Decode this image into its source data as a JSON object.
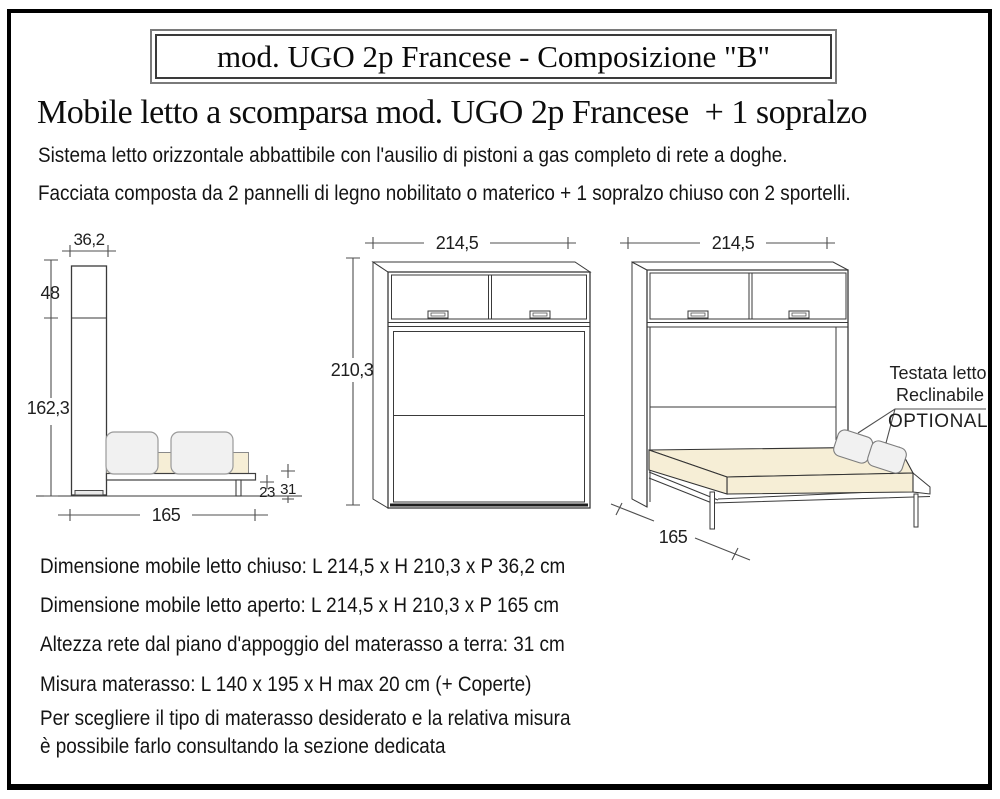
{
  "title_box": {
    "text": "mod. UGO 2p Francese - Composizione \"B\""
  },
  "heading": "Mobile letto a scomparsa mod. UGO 2p Francese  + 1 sopralzo",
  "intro": [
    "Sistema letto orizzontale abbattibile con l'ausilio di pistoni a gas completo di rete a doghe.",
    "Facciata composta da 2 pannelli di legno nobilitato o materico + 1 sopralzo chiuso con 2 sportelli."
  ],
  "diagrams": {
    "side_view": {
      "depth_closed_cm": "36,2",
      "sopralzo_height_cm": "48",
      "body_height_cm": "162,3",
      "depth_open_cm": "165",
      "platform_height_cm": "23",
      "rete_height_cm": "31"
    },
    "front_view": {
      "width_cm": "214,5",
      "height_cm": "210,3"
    },
    "open_view": {
      "width_cm": "214,5",
      "depth_open_cm": "165",
      "headboard_line1": "Testata letto",
      "headboard_line2": "Reclinabile",
      "headboard_line3": "OPTIONAL"
    }
  },
  "specs": [
    "Dimensione mobile letto chiuso: L 214,5 x H 210,3 x P 36,2 cm",
    "Dimensione mobile letto aperto: L 214,5 x H 210,3 x P 165 cm",
    "Altezza rete dal piano d'appoggio del materasso a terra: 31 cm",
    "Misura materasso: L 140 x 195 x H max 20 cm (+ Coperte)"
  ],
  "note": [
    "Per scegliere il tipo di materasso desiderato e la relativa misura",
    "è possibile farlo consultando la sezione dedicata"
  ],
  "colors": {
    "mattress": "#F6EED6",
    "cushion": "#F1F1F1"
  }
}
